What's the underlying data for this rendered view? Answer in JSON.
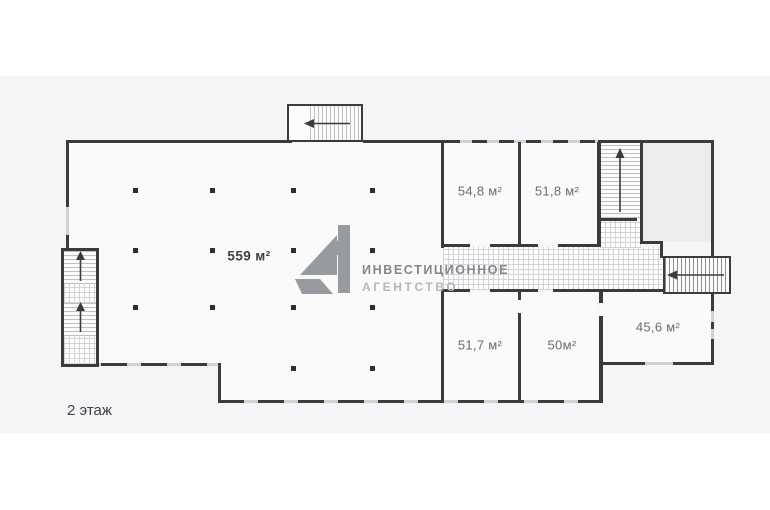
{
  "page": {
    "background": "#ffffff",
    "canvas_background": "#f5f5f7"
  },
  "floor_plan": {
    "floor_label": "2 этаж",
    "main_hall": {
      "area_label": "559 м²"
    },
    "rooms": [
      {
        "id": "room-54-8",
        "area_label": "54,8 м²"
      },
      {
        "id": "room-51-8",
        "area_label": "51,8 м²"
      },
      {
        "id": "room-51-7",
        "area_label": "51,7 м²"
      },
      {
        "id": "room-50",
        "area_label": "50м²"
      },
      {
        "id": "room-45-6",
        "area_label": "45,6 м²"
      }
    ],
    "stairs": [
      {
        "id": "stairs-top",
        "direction_icon": "arrow-left-icon"
      },
      {
        "id": "stairs-left-shaft",
        "direction_icon": "arrow-up-icon"
      },
      {
        "id": "stairs-top-right",
        "direction_icon": "arrow-up-icon"
      },
      {
        "id": "stairs-right-exit",
        "direction_icon": "arrow-left-icon"
      }
    ]
  },
  "watermark": {
    "brand": "А1",
    "line1": "ИНВЕСТИЦИОННОЕ",
    "line2": "АГЕНТСТВО",
    "logo_color": "#8f9297",
    "line1_color": "#84878c",
    "line2_color": "#b4b7bc"
  },
  "colors": {
    "wall": "#3b3b3d",
    "window_segment": "#d2d2d6",
    "room_fill": "#fafafb",
    "shaded_area_fill": "#ededef",
    "column": "#2f2f31"
  }
}
